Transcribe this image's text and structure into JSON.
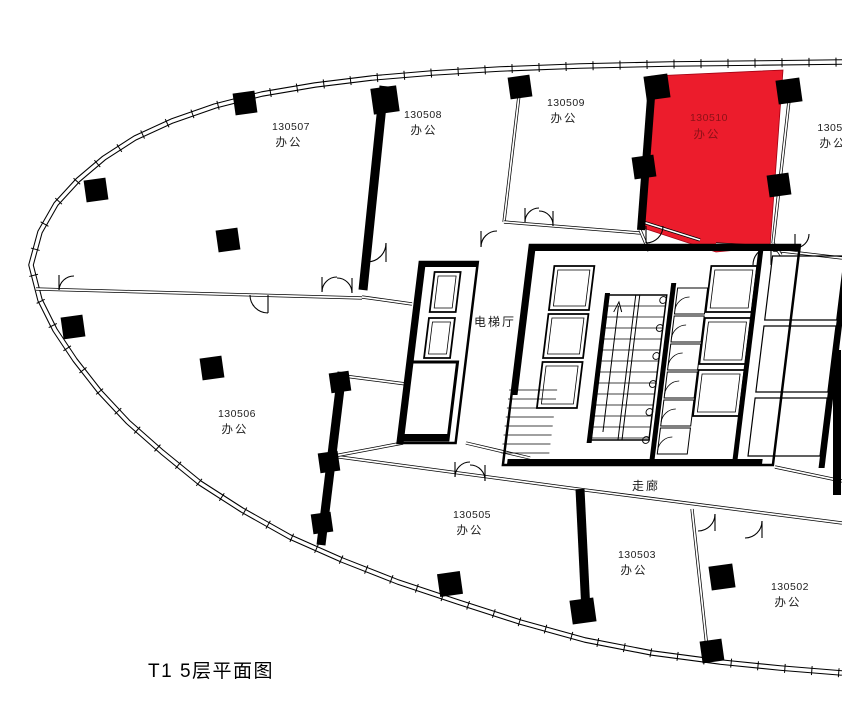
{
  "caption": "T1 5层平面图",
  "zones": {
    "elevator_hall": "电梯厅",
    "corridor": "走廊"
  },
  "rooms": [
    {
      "id": "130507",
      "type": "办公"
    },
    {
      "id": "130508",
      "type": "办公"
    },
    {
      "id": "130509",
      "type": "办公"
    },
    {
      "id": "130510",
      "type": "办公",
      "highlighted": true
    },
    {
      "id": "130511",
      "type": "办公"
    },
    {
      "id": "130506",
      "type": "办公"
    },
    {
      "id": "130505",
      "type": "办公"
    },
    {
      "id": "130503",
      "type": "办公"
    },
    {
      "id": "130502",
      "type": "办公"
    }
  ],
  "highlight": {
    "room_id": "130510",
    "fill": "#ec1c2c",
    "label_color": "#8c1117"
  },
  "colors": {
    "line": "#000000",
    "background": "#ffffff",
    "label": "#1a1a1a"
  }
}
